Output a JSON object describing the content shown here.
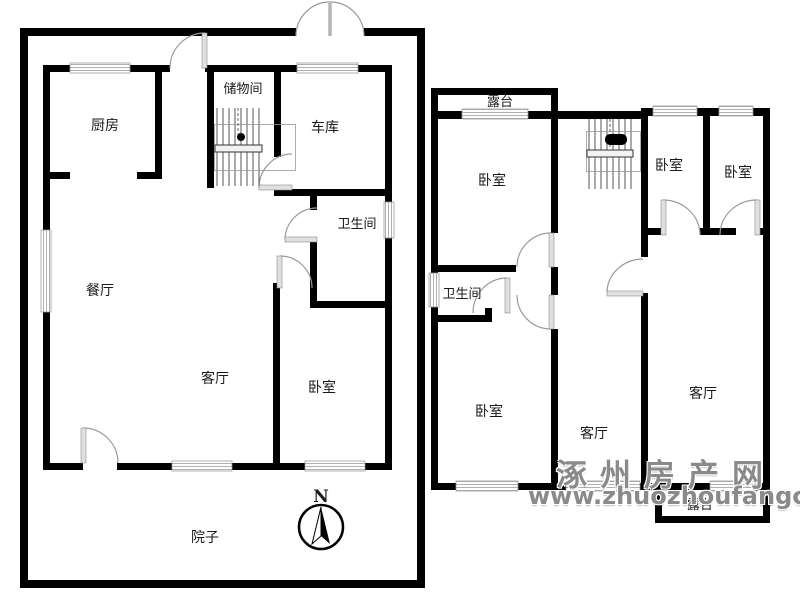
{
  "floor1": {
    "kitchen": "厨房",
    "storage": "储物间",
    "garage": "车库",
    "bathroom": "卫生间",
    "dining": "餐厅",
    "living": "客厅",
    "bedroom": "卧室",
    "yard": "院子"
  },
  "floor2": {
    "terrace_top": "露台",
    "bedroom_nw": "卧室",
    "bathroom": "卫生间",
    "bedroom_sw": "卧室",
    "living_mid": "客厅",
    "bedroom_ne_left": "卧室",
    "bedroom_ne_right": "卧室",
    "living_east": "客厅",
    "terrace_bottom": "露台"
  },
  "compass": {
    "label": "N"
  },
  "watermark": {
    "line1": "涿州房产网",
    "line2": "www.zhuozhoufangchan.com"
  },
  "colors": {
    "wall": "#000000",
    "window": "#b0b0b0",
    "door_arc": "#9a9a9a",
    "watermark": "#8a8a8a",
    "background": "#ffffff"
  }
}
